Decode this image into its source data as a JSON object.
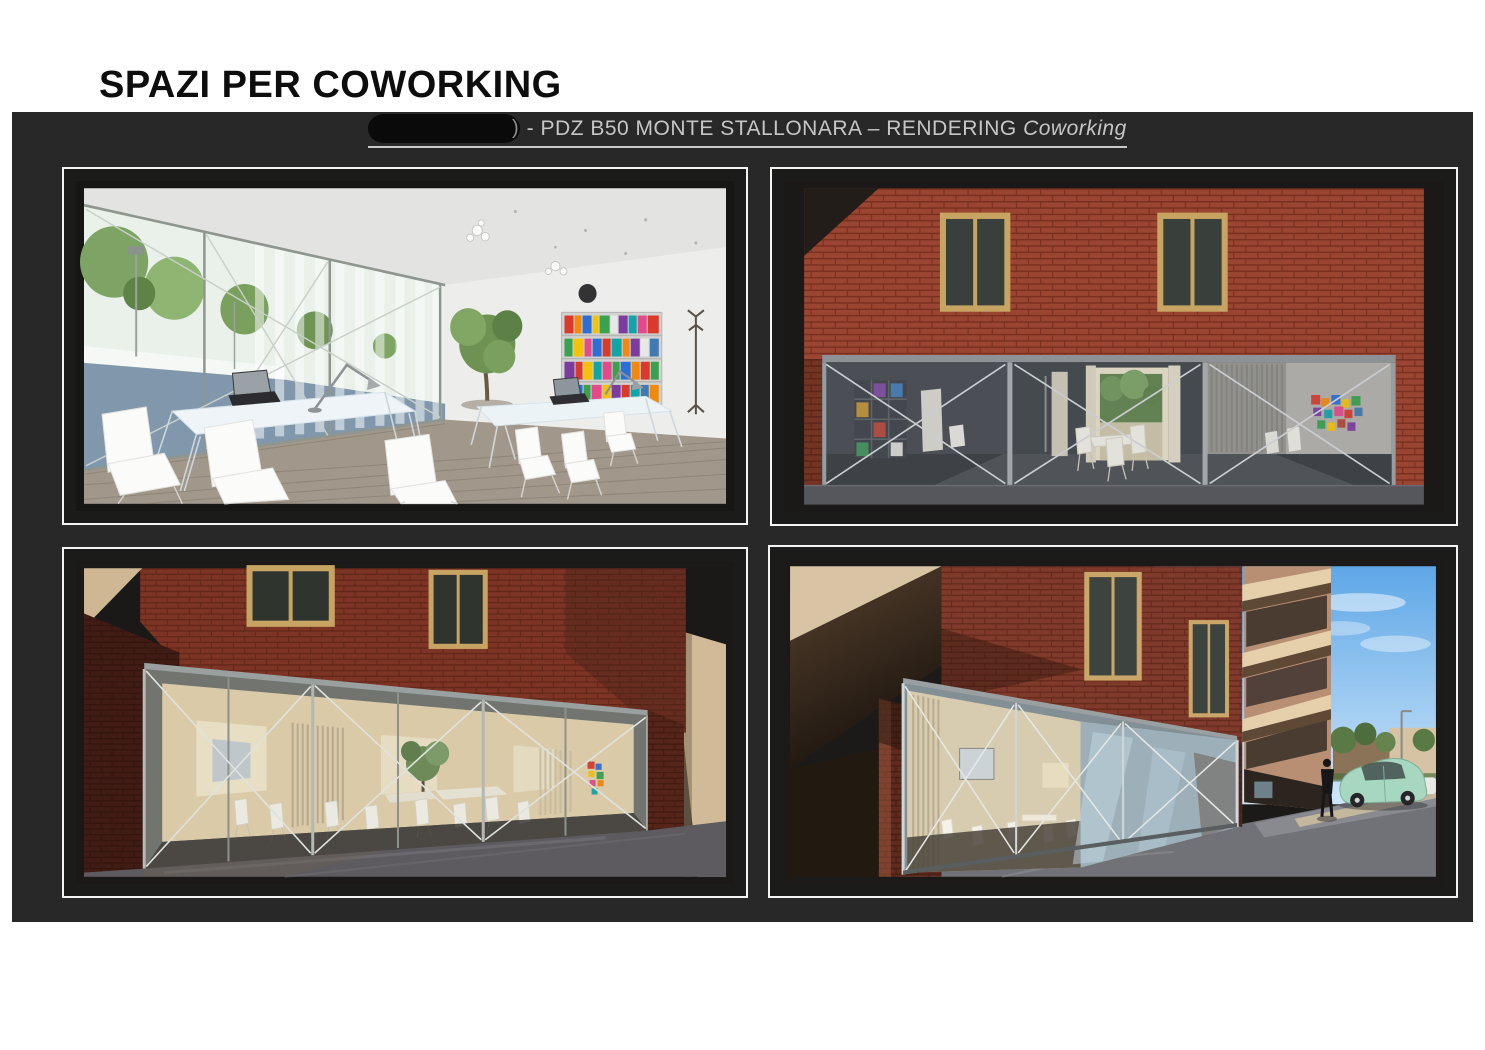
{
  "page": {
    "title": "SPAZI PER COWORKING"
  },
  "board": {
    "background": "#282828",
    "caption": {
      "paren": ")",
      "prefix": "- PDZ B50 MONTE STALLONARA – RENDERING ",
      "emphasis": "Coworking"
    }
  },
  "figures": [
    {
      "id": "interior",
      "alt": "Interior rendering of coworking space with white tables and chairs, desk lamps, colorful bookshelf and glass wall onto trees"
    },
    {
      "id": "facade",
      "alt": "Exterior rendering of red brick facade with two wood-framed windows and glazed cross-braced ground floor"
    },
    {
      "id": "glass-front",
      "alt": "Exterior rendering of glazed coworking front with warm interior, tables, chairs and small tree"
    },
    {
      "id": "street-corner",
      "alt": "Street corner rendering with brick building, stacked balconies, glazed ground floor, green car and pedestrian"
    }
  ],
  "colors": {
    "board_bg": "#282828",
    "frame_border": "#f4f4f4",
    "caption_text": "#c6c6c6",
    "brick": "#8f4030",
    "glass": "#5d6268",
    "sky": "#6db2ec",
    "car": "#a7d7c0"
  }
}
